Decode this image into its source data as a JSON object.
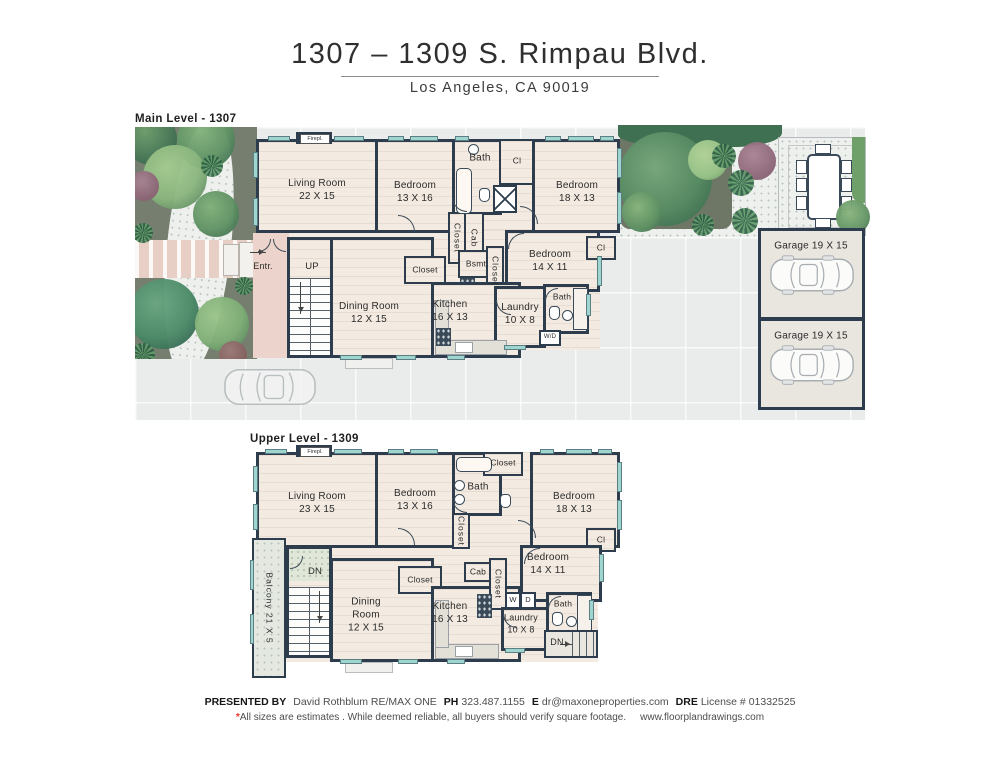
{
  "header": {
    "title": "1307 – 1309 S. Rimpau Blvd.",
    "subtitle": "Los Angeles, CA 90019"
  },
  "main_level": {
    "label": "Main Level - 1307",
    "fireplace": "Firepl.",
    "entry": "Entr.",
    "stairs_up": "UP",
    "rooms": {
      "living": {
        "name": "Living Room",
        "dims": "22 X 15"
      },
      "bedroom1": {
        "name": "Bedroom",
        "dims": "13 X 16"
      },
      "bath1": "Bath",
      "cl1": "Cl",
      "bedroom2": {
        "name": "Bedroom",
        "dims": "18 X 13"
      },
      "closet_hall": "Closet",
      "cab": "Cab",
      "bedroom3": {
        "name": "Bedroom",
        "dims": "14 X 11"
      },
      "cl2": "Cl",
      "bsmt": "Bsmt",
      "closet_bsmt": "Closet",
      "dining": {
        "name": "Dining Room",
        "dims": "12 X 15"
      },
      "closet_mid": "Closet",
      "kitchen": {
        "name": "Kitchen",
        "dims": "16 X 13"
      },
      "laundry": {
        "name": "Laundry",
        "dims": "10 X 8"
      },
      "bath2": "Bath",
      "wd": "W/D"
    },
    "garages": [
      {
        "label": "Garage 19 X 15"
      },
      {
        "label": "Garage 19 X 15"
      }
    ]
  },
  "upper_level": {
    "label": "Upper Level - 1309",
    "fireplace": "Firepl.",
    "stairs_dn_left": "DN",
    "stairs_dn_right": "DN",
    "rooms": {
      "living": {
        "name": "Living Room",
        "dims": "23 X 15"
      },
      "bedroom1": {
        "name": "Bedroom",
        "dims": "13 X 16"
      },
      "bath1": "Bath",
      "closet_top": "Closet",
      "bedroom2": {
        "name": "Bedroom",
        "dims": "18 X 13"
      },
      "closet_hall": "Closet",
      "cl": "Cl",
      "bedroom3": {
        "name": "Bedroom",
        "dims": "14 X 11"
      },
      "balcony": "Balcony 21 X 5",
      "dining": {
        "line1": "Dining",
        "line2": "Room",
        "dims": "12 X 15"
      },
      "closet_mid": "Closet",
      "kitchen": {
        "name": "Kitchen",
        "dims": "16 X 13"
      },
      "cab": "Cab",
      "closet_laundry": "Closet",
      "washer": "W",
      "dryer": "D",
      "laundry": {
        "name": "Laundry",
        "dims": "10 X 8"
      },
      "bath2": "Bath"
    }
  },
  "footer": {
    "presented_by": "PRESENTED BY",
    "agent": "David Rothblum  RE/MAX ONE",
    "ph_label": "PH",
    "phone": "323.487.1155",
    "email_label": "E",
    "email": "dr@maxoneproperties.com",
    "dre_label": "DRE",
    "dre_value": "License # 01332525",
    "asterisk": "*",
    "disclaimer": "All sizes are estimates . While deemed reliable, all buyers should verify square footage.",
    "website": "www.floorplandrawings.com"
  },
  "colors": {
    "wall": "#2d3d4d",
    "floor": "#f3eae1",
    "window": "#9ed5cf",
    "accent_red": "#e8332a"
  }
}
